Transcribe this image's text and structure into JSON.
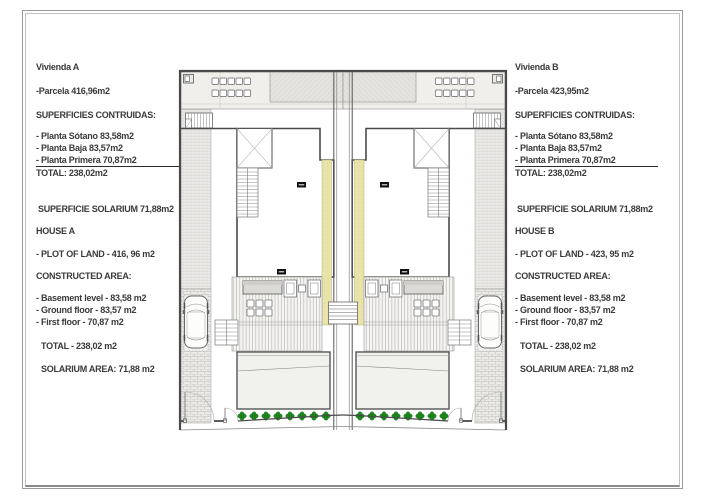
{
  "sheet": {
    "background": "#ffffff",
    "frame_color": "#9a9a9a",
    "text_color": "#3a3a3a"
  },
  "vivienda_a": {
    "title": "Vivienda A",
    "parcela": "-Parcela 416,96m2",
    "superficies_heading": "SUPERFICIES CONTRUIDAS:",
    "planta_sotano": "- Planta Sótano 83,58m2",
    "planta_baja": "- Planta Baja 83,57m2",
    "planta_primera": "- Planta Primera 70,87m2",
    "total_es": "TOTAL: 238,02m2",
    "superficie_solarium": "SUPERFICIE SOLARIUM 71,88m2",
    "house": "HOUSE A",
    "plot_of_land": "- PLOT OF LAND - 416, 96 m2",
    "constructed_heading": "CONSTRUCTED AREA:",
    "basement": "- Basement level - 83,58 m2",
    "ground_floor": "- Ground floor - 83,57 m2",
    "first_floor": "- First floor - 70,87 m2",
    "total_en": "TOTAL - 238,02 m2",
    "solarium_en": "SOLARIUM AREA: 71,88 m2"
  },
  "vivienda_b": {
    "title": "Vivienda B",
    "parcela": "-Parcela 423,95m2",
    "superficies_heading": "SUPERFICIES CONTRUIDAS:",
    "planta_sotano": "- Planta Sótano 83,58m2",
    "planta_baja": "- Planta Baja 83,57m2",
    "planta_primera": "- Planta Primera 70,87m2",
    "total_es": "TOTAL: 238,02m2",
    "superficie_solarium": "SUPERFICIE SOLARIUM 71,88m2",
    "house": "HOUSE B",
    "plot_of_land": "- PLOT OF LAND - 423, 95 m2",
    "constructed_heading": "CONSTRUCTED AREA:",
    "basement": "- Basement level - 83,58 m2",
    "ground_floor": "- Ground floor - 83,57 m2",
    "first_floor": "- First floor - 70,87 m2",
    "total_en": "TOTAL - 238,02 m2",
    "solarium_en": "SOLARIUM AREA: 71,88 m2"
  },
  "plan": {
    "colors": {
      "wall": "#4a4a4a",
      "solarium_fill": "#f0efec",
      "roof_gray": "#e4e3e0",
      "party_wall_yellow": "#e9e5aa",
      "plant_green": "#1e8a1e",
      "planter_gray": "#dbdad7",
      "pool_fill": "#f1f1ee"
    }
  }
}
